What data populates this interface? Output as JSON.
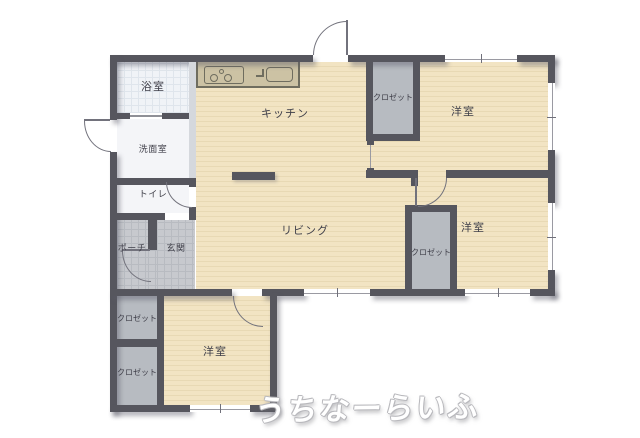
{
  "watermark": "うちなーらいふ",
  "rooms": {
    "bath": {
      "label": "浴室"
    },
    "washroom": {
      "label": "洗面室"
    },
    "toilet": {
      "label": "トイレ"
    },
    "porch": {
      "label": "ポーチ"
    },
    "entrance": {
      "label": "玄関"
    },
    "kitchen": {
      "label": "キッチン"
    },
    "living": {
      "label": "リビング"
    },
    "bedroom_ne": {
      "label": "洋室"
    },
    "bedroom_e": {
      "label": "洋室"
    },
    "bedroom_s": {
      "label": "洋室"
    },
    "closet_ne": {
      "label": "クロゼット"
    },
    "closet_e": {
      "label": "クロゼット"
    },
    "closet_w_upper": {
      "label": "クロゼット"
    },
    "closet_w_lower": {
      "label": "クロゼット"
    }
  },
  "colors": {
    "wall": "#56565e",
    "floor": "#f2e4c3",
    "floor_stripe": "#e8d9b4",
    "closet_fill": "#b7bbc1",
    "entrance_tile": "#c7c9ce",
    "bath_tile": "#f0f3f7",
    "counter": "#ccc2a4"
  }
}
